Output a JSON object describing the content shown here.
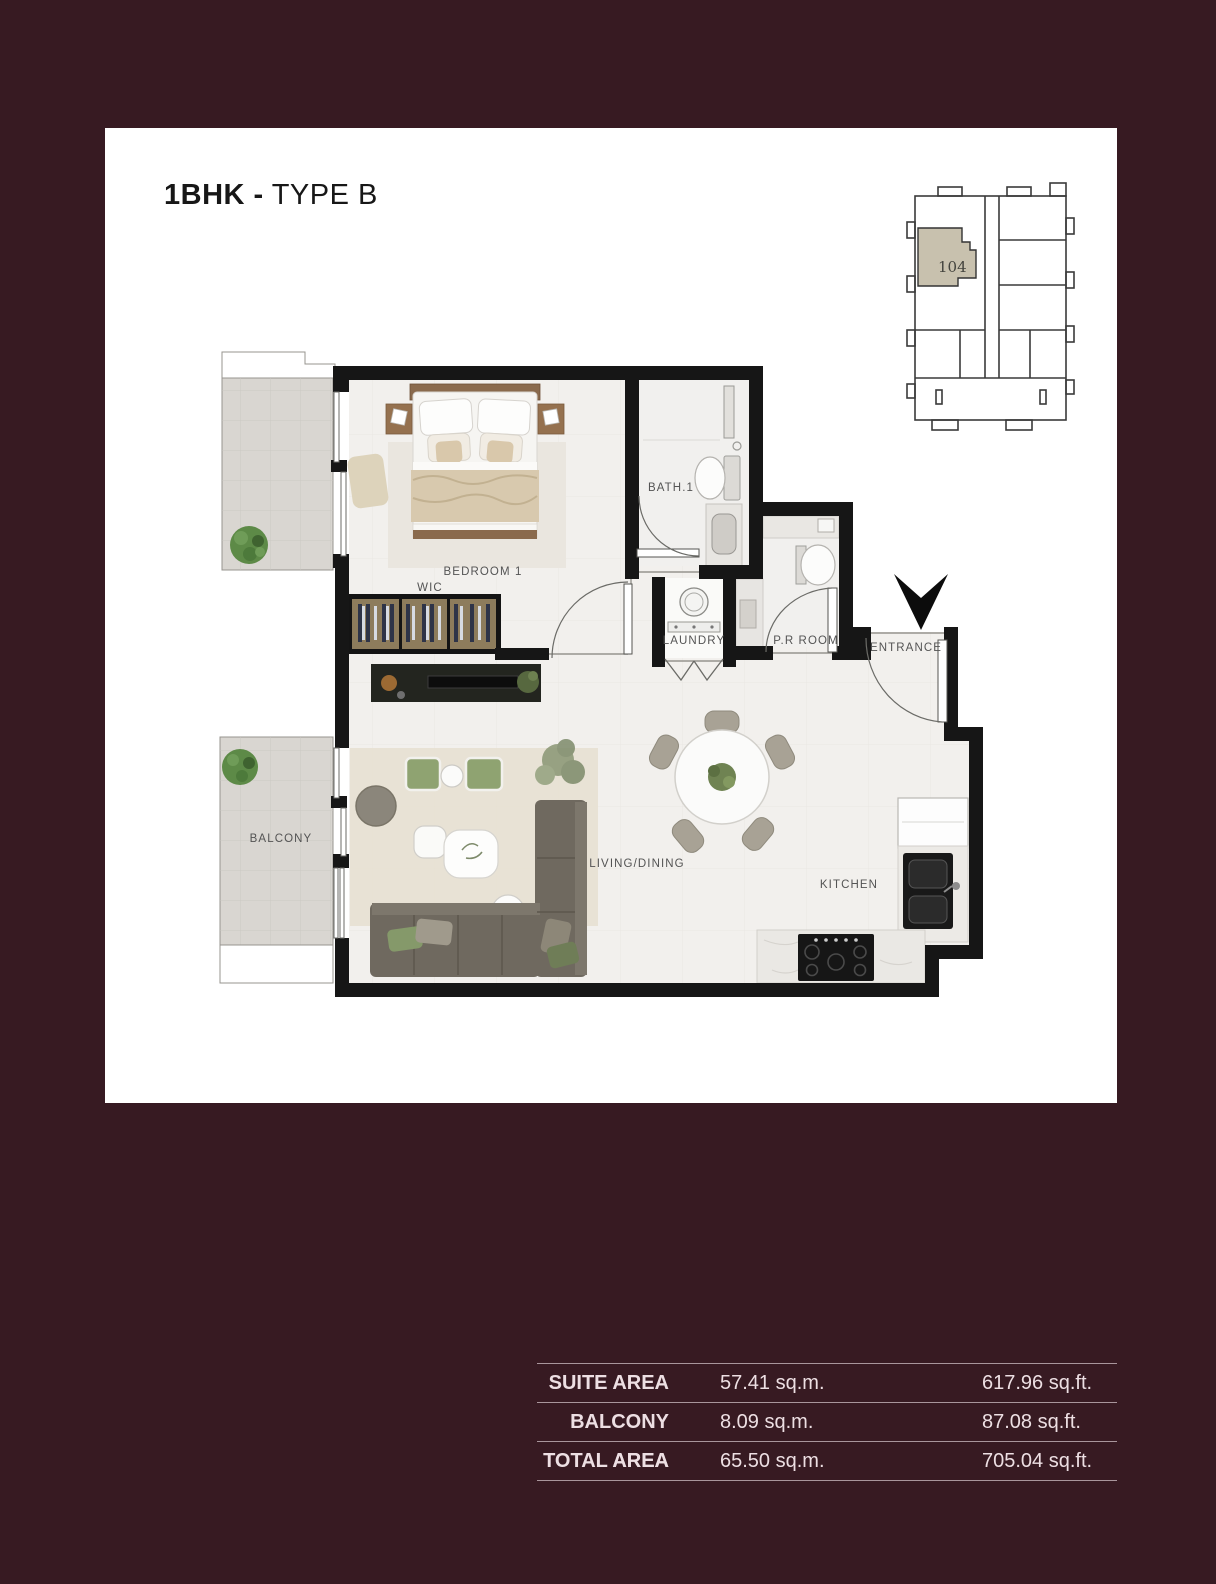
{
  "page": {
    "background": "#371a22",
    "card": "#ffffff",
    "wall_color": "#161616",
    "unit_fill": "#c8c1ae"
  },
  "title": {
    "bold": "1BHK -",
    "regular": "TYPE B"
  },
  "key_plan": {
    "unit": "104"
  },
  "plan": {
    "labels": {
      "bedroom": "BEDROOM 1",
      "wic": "WIC",
      "bath": "BATH.1",
      "laundry": "LAUNDRY",
      "pr_room": "P.R ROOM",
      "entrance": "ENTRANCE",
      "balcony": "BALCONY",
      "living": "LIVING/DINING",
      "kitchen": "KITCHEN"
    }
  },
  "area_table": {
    "rows": [
      {
        "label": "SUITE AREA",
        "sqm": "57.41 sq.m.",
        "sqft": "617.96 sq.ft."
      },
      {
        "label": "BALCONY AREA",
        "sqm": "8.09 sq.m.",
        "sqft": "87.08 sq.ft."
      },
      {
        "label": "TOTAL AREA",
        "sqm": "65.50 sq.m.",
        "sqft": "705.04 sq.ft."
      }
    ]
  }
}
